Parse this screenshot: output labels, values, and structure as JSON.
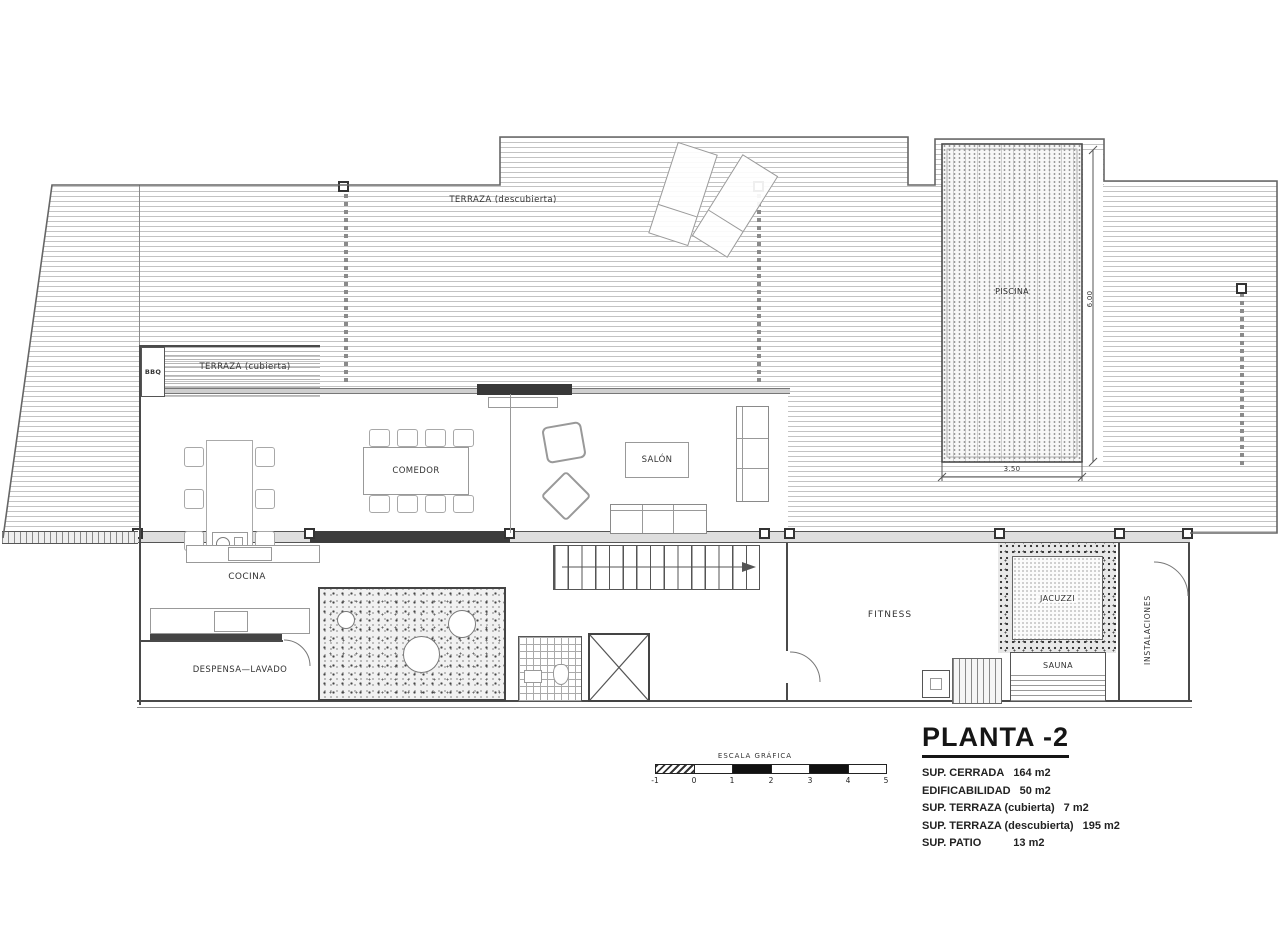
{
  "title_block": {
    "title": "PLANTA -2",
    "stats": [
      {
        "label": "SUP. CERRADA",
        "value": "164 m2"
      },
      {
        "label": "EDIFICABILIDAD",
        "value": "50 m2"
      },
      {
        "label": "SUP. TERRAZA (cubierta)",
        "value": "7 m2"
      },
      {
        "label": "SUP. TERRAZA (descubierta)",
        "value": "195 m2"
      },
      {
        "label": "SUP. PATIO",
        "value": "13 m2"
      }
    ]
  },
  "rooms": {
    "terraza_descubierta": "TERRAZA  (descubierta)",
    "terraza_cubierta": "TERRAZA  (cubierta)",
    "bbq": "BBQ",
    "comedor": "COMEDOR",
    "salon": "SALÓN",
    "cocina": "COCINA",
    "despensa_lavado": "DESPENSA—LAVADO",
    "piscina": "PISCINA",
    "fitness": "FITNESS",
    "jacuzzi": "JACUZZI",
    "sauna": "SAUNA",
    "instalaciones": "INSTALACIONES"
  },
  "dimensions": {
    "pool_length": "6.00",
    "pool_width": "3.50"
  },
  "scale_bar": {
    "title": "ESCALA GRÁFICA",
    "ticks": [
      "-1",
      "0",
      "1",
      "2",
      "3",
      "4",
      "5"
    ]
  }
}
